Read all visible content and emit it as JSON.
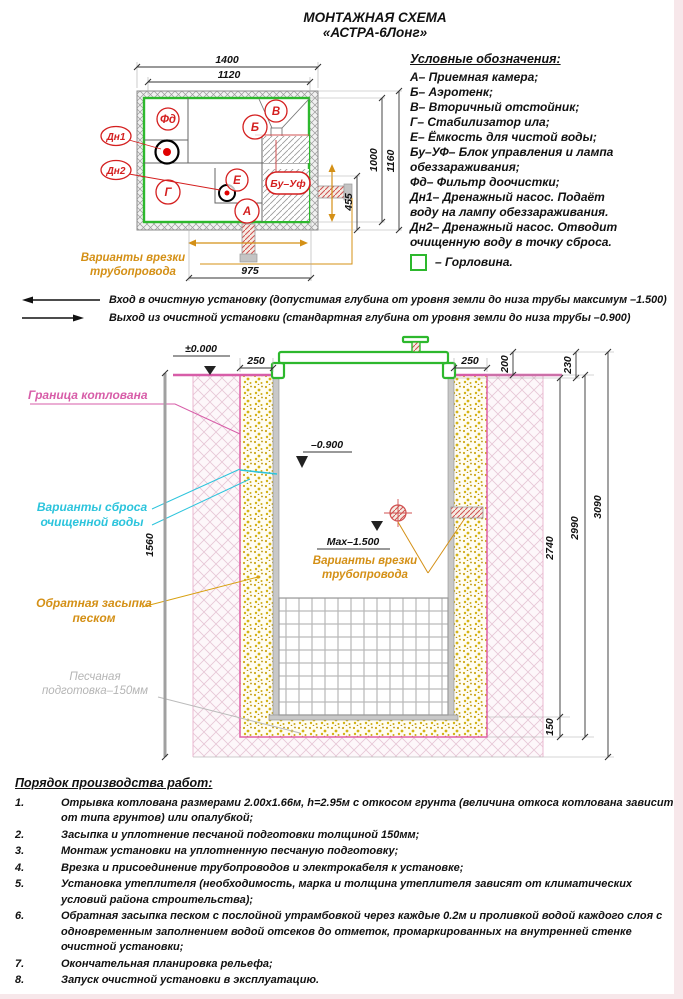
{
  "title": {
    "line1": "МОНТАЖНАЯ СХЕМА",
    "line2": "«АСТРА-6Лонг»"
  },
  "plan": {
    "dims": {
      "outer_width": "1400",
      "inner_width": "1120",
      "inner_height": "1000",
      "outer_height": "1160",
      "inlet_offset": "455",
      "bottom_width": "975"
    },
    "compartments": {
      "fd": "Фд",
      "b": "Б",
      "v": "В",
      "g": "Г",
      "e": "Е",
      "a": "А",
      "bu": "Бу–Уф"
    },
    "pumps": {
      "dn1": "Дн1",
      "dn2": "Дн2"
    },
    "note": [
      "Варианты врезки",
      "трубопровода"
    ]
  },
  "legend": {
    "heading": "Условные обозначения:",
    "lines": [
      "А– Приемная камера;",
      "Б– Аэротенк;",
      "В– Вторичный отстойник;",
      "Г– Стабилизатор ила;",
      "Е– Ёмкость для чистой воды;",
      "Бу–УФ– Блок управления и лампа",
      "обеззараживания;",
      "Фд– Фильтр доочистки;",
      "Дн1– Дренажный насос. Подаёт",
      "воду на лампу обеззараживания.",
      "Дн2– Дренажный насос. Отводит",
      "очищенную воду в точку сброса.",
      "– Горловина."
    ]
  },
  "io": {
    "in": "Вход в очистную установку (допустимая глубина от уровня земли до низа трубы максимум –1.500)",
    "out": "Выход из очистной установки (стандартная глубина от уровня земли до низа трубы –0.900)"
  },
  "section": {
    "levels": {
      "zero": "±0.000",
      "discharge": "–0.900",
      "max": "Max–1.500"
    },
    "dims": {
      "left_gap": "250",
      "right_gap": "250",
      "lid_height": "200",
      "collar": "230",
      "tank": "2740",
      "pit": "2990",
      "total": "3090",
      "bed": "150",
      "left_total": "1560"
    },
    "labels": {
      "boundary": "Граница котлована",
      "discharge": [
        "Варианты сброса",
        "очищенной воды"
      ],
      "backfill": [
        "Обратная засыпка",
        "песком"
      ],
      "bed": [
        "Песчаная",
        "подготовка–150мм"
      ],
      "inlet": [
        "Варианты врезки",
        "трубопровода"
      ]
    }
  },
  "procedure": {
    "heading": "Порядок производства работ:",
    "items": [
      {
        "num": "1.",
        "text": "Отрывка котлована размерами 2.00х1.66м, h=2.95м с откосом грунта (величина откоса котлована зависит от типа грунтов) или опалубкой;"
      },
      {
        "num": "2.",
        "text": "Засыпка и уплотнение песчаной подготовки толщиной 150мм;"
      },
      {
        "num": "3.",
        "text": "Монтаж установки на уплотненную песчаную подготовку;"
      },
      {
        "num": "4.",
        "text": "Врезка и присоединение трубопроводов и электрокабеля к установке;"
      },
      {
        "num": "5.",
        "text": "Установка утеплителя (необходимость, марка и толщина утеплителя зависят от климатических условий района строительства);"
      },
      {
        "num": "6.",
        "text": "Обратная засыпка песком с послойной утрамбовкой через каждые 0.2м и проливкой водой каждого слоя с одновременным заполнением водой отсеков до отметок, промаркированных на внутренней стенке очистной установки;"
      },
      {
        "num": "7.",
        "text": "Окончательная планировка рельефа;"
      },
      {
        "num": "8.",
        "text": "Запуск очистной установки в эксплуатацию."
      }
    ]
  },
  "colors": {
    "accent_green": "#2db82d",
    "label_red": "#d41f1f",
    "magenta": "#d75da8",
    "cyan": "#2cc4dc",
    "orange": "#d49016",
    "sand": "#d4b316"
  }
}
